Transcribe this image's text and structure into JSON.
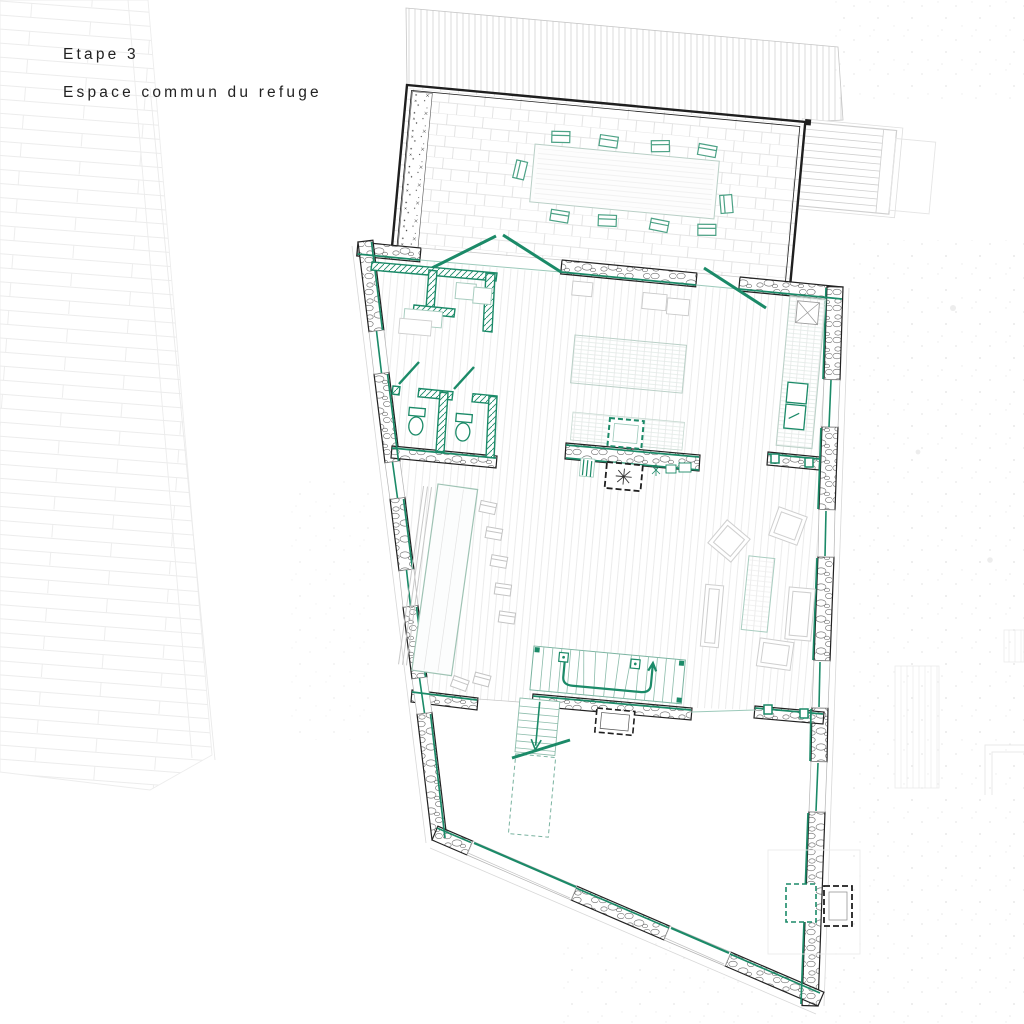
{
  "title": {
    "line1": "Etape 3",
    "line2": "Espace commun du refuge"
  },
  "palette": {
    "accent_teal": "#1b8a68",
    "teal_light": "#8cbcab",
    "teal_pale": "#a9cdc0",
    "wall_black": "#1f1f1f",
    "furniture_gray": "#c9c9c9",
    "texture_gray": "#ececec",
    "paper_white": "#ffffff"
  },
  "plan_features": {
    "terrace": "paved terrace with planter strip, long dining table and ten chairs",
    "exterior_stair": "exterior stair at terrace right",
    "storage_room": "teal partition storage room top-left",
    "bathrooms": "two WC cubicles with teal partitions",
    "kitchen": "kitchen island, counters and sink along right wall",
    "stove": "central wood stove with masonry flue",
    "long_table": "long refectory table with bench and chairs",
    "lounge": "lounge with two armchairs, two sofas and coffee table",
    "u_stair": "U-shaped stair going up",
    "down_stair": "straight stair going down with dashed lower flight",
    "annex": "small chimney annex at bottom-right"
  }
}
